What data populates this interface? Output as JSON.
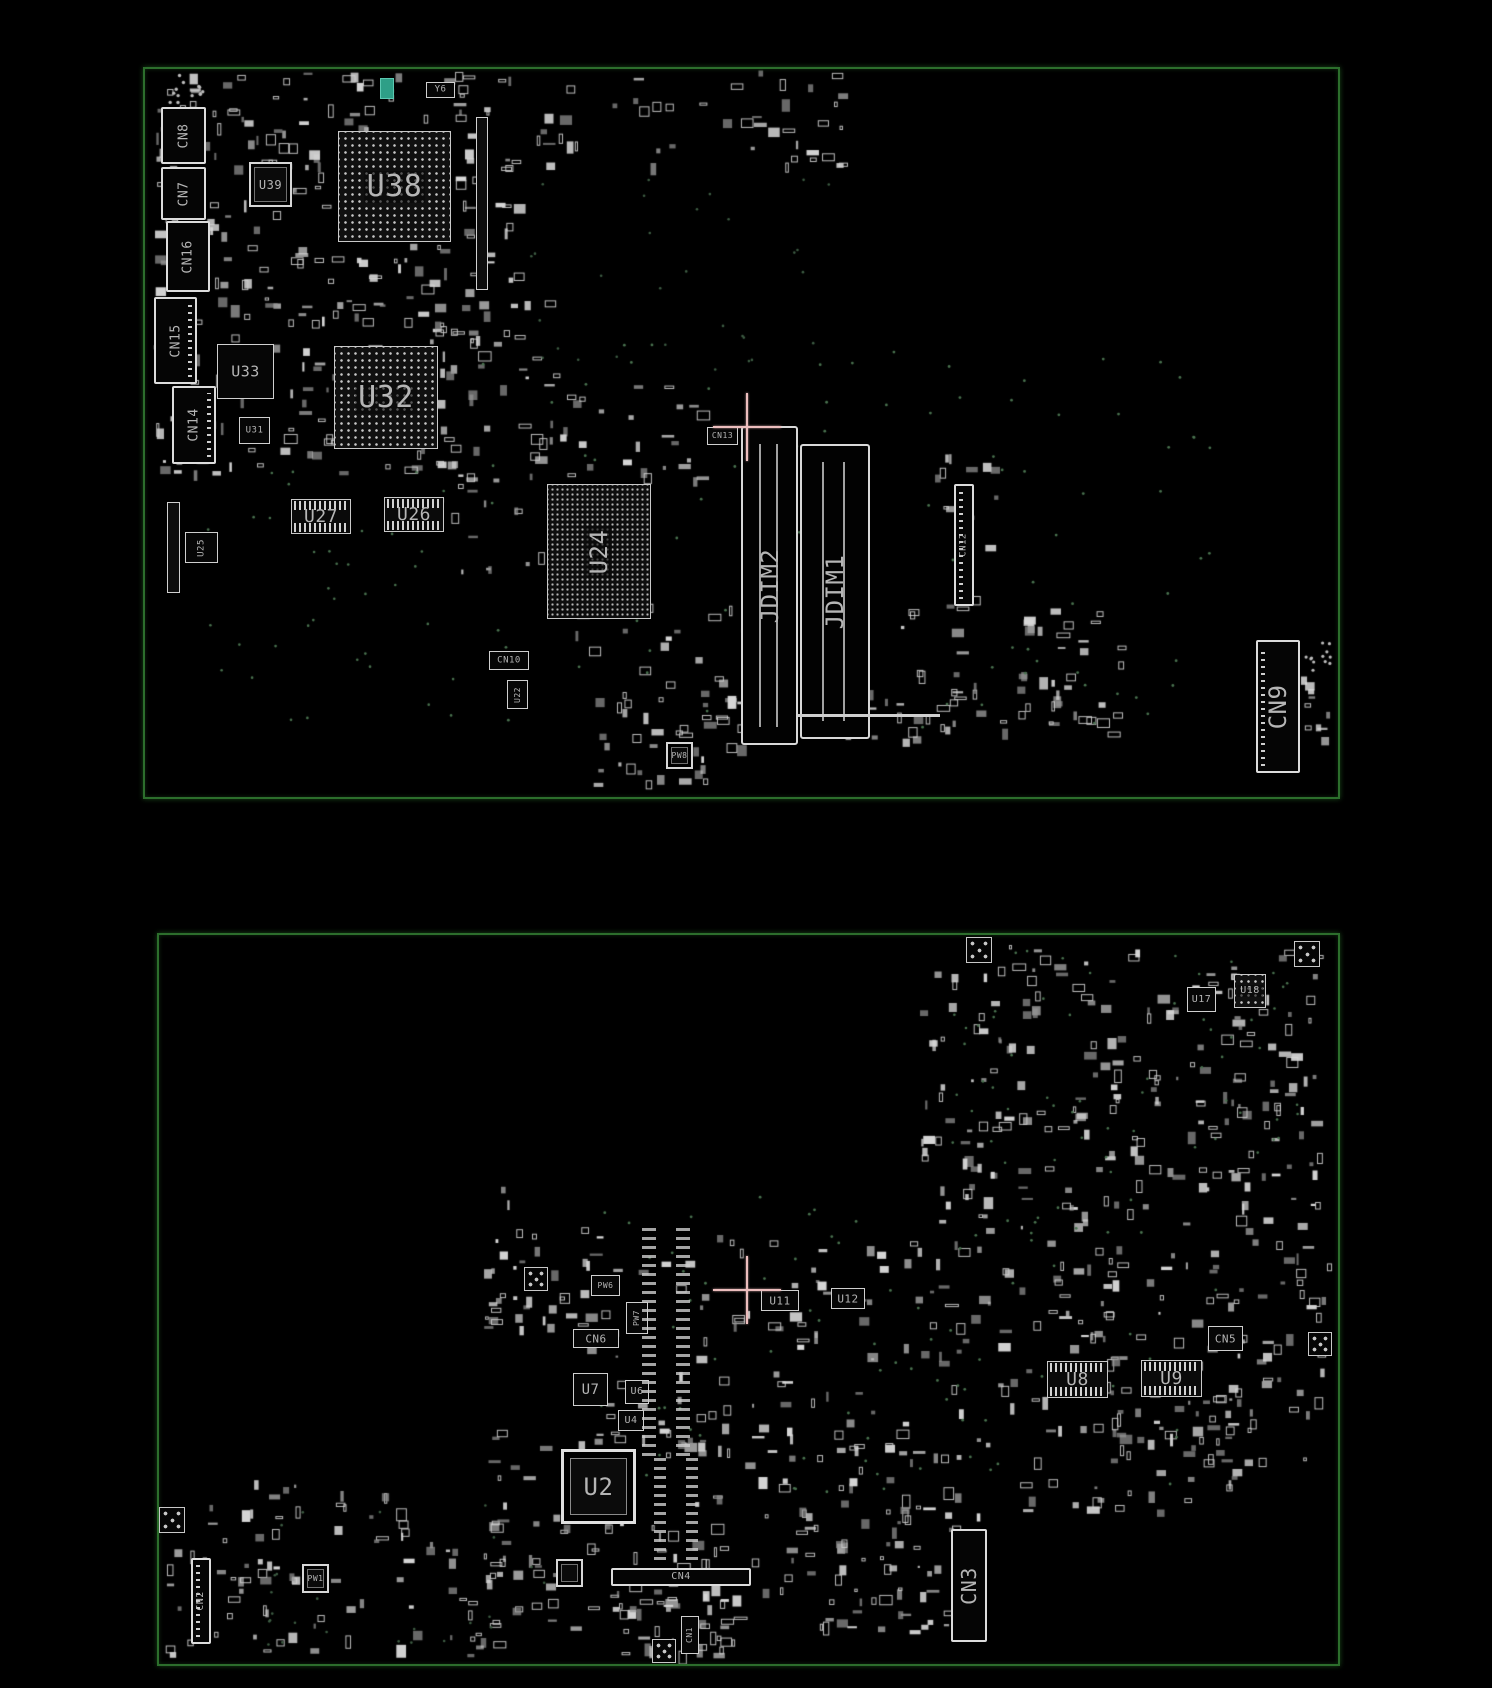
{
  "image": {
    "width": 1492,
    "height": 1688,
    "description": "PCB boardview drawing, two board sides on black background"
  },
  "colors": {
    "background": "#000000",
    "board_outline": "#2c6e2c",
    "component_stroke": "#d6d6d6",
    "component_dim": "#969696",
    "label_text": "#b5b5b5",
    "via_green": "#49724f",
    "crosshair": "#ecbdbd",
    "accent_teal": "#2e9f87"
  },
  "boards": [
    {
      "name": "board-top-side",
      "outline": {
        "x": 143,
        "y": 67,
        "w": 1193,
        "h": 728
      },
      "crosshair": {
        "x": 747,
        "y": 427,
        "arm": 34
      },
      "components": [
        {
          "label": "CN8",
          "type": "connector",
          "x": 161,
          "y": 107,
          "w": 45,
          "h": 57,
          "fs": 13,
          "rot": -90
        },
        {
          "label": "CN7",
          "type": "connector",
          "x": 161,
          "y": 167,
          "w": 45,
          "h": 53,
          "fs": 13,
          "rot": -90
        },
        {
          "label": "CN16",
          "type": "connector",
          "x": 166,
          "y": 221,
          "w": 44,
          "h": 71,
          "fs": 13,
          "rot": -90
        },
        {
          "label": "CN15",
          "type": "connector",
          "x": 154,
          "y": 297,
          "w": 43,
          "h": 87,
          "fs": 13,
          "rot": -90,
          "pins": "right"
        },
        {
          "label": "CN14",
          "type": "connector",
          "x": 172,
          "y": 386,
          "w": 44,
          "h": 78,
          "fs": 13,
          "rot": -90,
          "pins": "right"
        },
        {
          "label": "U39",
          "type": "qfp",
          "x": 249,
          "y": 162,
          "w": 43,
          "h": 45,
          "fs": 12
        },
        {
          "label": "U38",
          "type": "bga",
          "x": 338,
          "y": 131,
          "w": 113,
          "h": 111,
          "fs": 30
        },
        {
          "label": "U33",
          "type": "box",
          "x": 217,
          "y": 344,
          "w": 57,
          "h": 55,
          "fs": 15
        },
        {
          "label": "U31",
          "type": "box",
          "x": 239,
          "y": 417,
          "w": 31,
          "h": 27,
          "fs": 9
        },
        {
          "label": "U32",
          "type": "bga",
          "x": 334,
          "y": 346,
          "w": 104,
          "h": 103,
          "fs": 30
        },
        {
          "label": "U25",
          "type": "box",
          "x": 185,
          "y": 532,
          "w": 33,
          "h": 31,
          "fs": 9,
          "rot": -90
        },
        {
          "label": "U27",
          "type": "pinarray",
          "x": 291,
          "y": 499,
          "w": 60,
          "h": 35,
          "fs": 18
        },
        {
          "label": "U26",
          "type": "pinarray",
          "x": 384,
          "y": 497,
          "w": 60,
          "h": 35,
          "fs": 18
        },
        {
          "label": "U24",
          "type": "bga-fine",
          "x": 547,
          "y": 484,
          "w": 104,
          "h": 135,
          "fs": 24,
          "rot": -90
        },
        {
          "label": "JDIM2",
          "type": "slot",
          "x": 741,
          "y": 426,
          "w": 57,
          "h": 319,
          "fs": 24,
          "rot": -90
        },
        {
          "label": "JDIM1",
          "type": "slot",
          "x": 800,
          "y": 444,
          "w": 70,
          "h": 295,
          "fs": 24,
          "rot": -90
        },
        {
          "label": "CN13",
          "type": "box",
          "x": 707,
          "y": 427,
          "w": 31,
          "h": 18,
          "fs": 8
        },
        {
          "label": "CN12",
          "type": "connector",
          "x": 954,
          "y": 484,
          "w": 20,
          "h": 122,
          "fs": 9,
          "rot": -90,
          "pins": "left"
        },
        {
          "label": "CN9",
          "type": "connector",
          "x": 1256,
          "y": 640,
          "w": 44,
          "h": 133,
          "fs": 24,
          "rot": -90,
          "pins": "left"
        },
        {
          "label": "Y6",
          "type": "box",
          "x": 426,
          "y": 82,
          "w": 29,
          "h": 16,
          "fs": 9
        },
        {
          "label": "CN10",
          "type": "box",
          "x": 489,
          "y": 651,
          "w": 40,
          "h": 19,
          "fs": 9
        },
        {
          "label": "U22",
          "type": "box",
          "x": 507,
          "y": 680,
          "w": 21,
          "h": 29,
          "fs": 8,
          "rot": -90
        },
        {
          "label": "PW8",
          "type": "qfp",
          "x": 666,
          "y": 742,
          "w": 27,
          "h": 27,
          "fs": 8
        },
        {
          "label": "",
          "type": "bar",
          "x": 476,
          "y": 117,
          "w": 12,
          "h": 173
        },
        {
          "label": "",
          "type": "bar",
          "x": 167,
          "y": 502,
          "w": 13,
          "h": 91
        },
        {
          "label": "",
          "type": "hline",
          "x": 798,
          "y": 714,
          "w": 142,
          "h": 3
        },
        {
          "label": "",
          "type": "teal",
          "x": 380,
          "y": 78,
          "w": 14,
          "h": 21
        }
      ],
      "texture_clusters": [
        {
          "x": 150,
          "y": 72,
          "w": 320,
          "h": 235,
          "count": 150,
          "seed": 1
        },
        {
          "x": 150,
          "y": 300,
          "w": 330,
          "h": 175,
          "count": 120,
          "seed": 2
        },
        {
          "x": 455,
          "y": 70,
          "w": 60,
          "h": 230,
          "count": 30,
          "seed": 3
        },
        {
          "x": 520,
          "y": 70,
          "w": 340,
          "h": 95,
          "count": 45,
          "seed": 4
        },
        {
          "x": 425,
          "y": 300,
          "w": 130,
          "h": 270,
          "count": 45,
          "seed": 5
        },
        {
          "x": 555,
          "y": 385,
          "w": 150,
          "h": 95,
          "count": 26,
          "seed": 6
        },
        {
          "x": 575,
          "y": 600,
          "w": 175,
          "h": 185,
          "count": 55,
          "seed": 7
        },
        {
          "x": 700,
          "y": 690,
          "w": 240,
          "h": 55,
          "count": 28,
          "seed": 8
        },
        {
          "x": 880,
          "y": 600,
          "w": 230,
          "h": 135,
          "count": 45,
          "seed": 9
        },
        {
          "x": 935,
          "y": 440,
          "w": 70,
          "h": 170,
          "count": 14,
          "seed": 10
        },
        {
          "x": 1010,
          "y": 610,
          "w": 110,
          "h": 120,
          "count": 20,
          "seed": 11
        },
        {
          "x": 1295,
          "y": 675,
          "w": 35,
          "h": 95,
          "count": 10,
          "seed": 12
        }
      ],
      "dot_fields": [
        {
          "x": 168,
          "y": 74,
          "w": 38,
          "h": 40,
          "count": 14,
          "r": 1.7,
          "color": "#bdbdbd",
          "seed": 41
        },
        {
          "x": 1306,
          "y": 642,
          "w": 28,
          "h": 32,
          "count": 12,
          "r": 1.6,
          "color": "#bdbdbd",
          "seed": 42
        },
        {
          "x": 450,
          "y": 340,
          "w": 760,
          "h": 390,
          "count": 90,
          "r": 1.4,
          "color": "#49724f",
          "seed": 43
        },
        {
          "x": 200,
          "y": 470,
          "w": 260,
          "h": 250,
          "count": 40,
          "r": 1.3,
          "color": "#49724f",
          "seed": 44
        },
        {
          "x": 530,
          "y": 175,
          "w": 340,
          "h": 200,
          "count": 30,
          "r": 1.3,
          "color": "#3d5c43",
          "seed": 45
        }
      ]
    },
    {
      "name": "board-bottom-side",
      "outline": {
        "x": 157,
        "y": 933,
        "w": 1179,
        "h": 729
      },
      "crosshair": {
        "x": 747,
        "y": 1290,
        "arm": 34
      },
      "components": [
        {
          "label": "U17",
          "type": "box",
          "x": 1187,
          "y": 987,
          "w": 29,
          "h": 25,
          "fs": 10
        },
        {
          "label": "U18",
          "type": "bga",
          "x": 1234,
          "y": 974,
          "w": 32,
          "h": 34,
          "fs": 10
        },
        {
          "label": "U11",
          "type": "box",
          "x": 761,
          "y": 1290,
          "w": 38,
          "h": 21,
          "fs": 11
        },
        {
          "label": "U12",
          "type": "box",
          "x": 831,
          "y": 1288,
          "w": 34,
          "h": 21,
          "fs": 11
        },
        {
          "label": "CN6",
          "type": "box",
          "x": 573,
          "y": 1329,
          "w": 46,
          "h": 19,
          "fs": 11
        },
        {
          "label": "U7",
          "type": "box",
          "x": 573,
          "y": 1373,
          "w": 35,
          "h": 33,
          "fs": 14
        },
        {
          "label": "U6",
          "type": "box",
          "x": 625,
          "y": 1380,
          "w": 24,
          "h": 24,
          "fs": 10
        },
        {
          "label": "U4",
          "type": "box",
          "x": 618,
          "y": 1410,
          "w": 26,
          "h": 21,
          "fs": 10
        },
        {
          "label": "U2",
          "type": "qfp-big",
          "x": 561,
          "y": 1449,
          "w": 75,
          "h": 75,
          "fs": 24
        },
        {
          "label": "CN4",
          "type": "connector-h",
          "x": 611,
          "y": 1568,
          "w": 140,
          "h": 18,
          "fs": 10
        },
        {
          "label": "CN1",
          "type": "box",
          "x": 681,
          "y": 1616,
          "w": 18,
          "h": 38,
          "fs": 8,
          "rot": -90
        },
        {
          "label": "CN2",
          "type": "connector",
          "x": 191,
          "y": 1558,
          "w": 20,
          "h": 86,
          "fs": 10,
          "rot": -90,
          "pins": "left"
        },
        {
          "label": "CN3",
          "type": "connector",
          "x": 951,
          "y": 1529,
          "w": 36,
          "h": 113,
          "fs": 20,
          "rot": -90
        },
        {
          "label": "U8",
          "type": "pinarray",
          "x": 1047,
          "y": 1361,
          "w": 61,
          "h": 37,
          "fs": 18
        },
        {
          "label": "U9",
          "type": "pinarray",
          "x": 1141,
          "y": 1360,
          "w": 61,
          "h": 37,
          "fs": 18
        },
        {
          "label": "CN5",
          "type": "box",
          "x": 1208,
          "y": 1326,
          "w": 35,
          "h": 25,
          "fs": 11
        },
        {
          "label": "PW6",
          "type": "box",
          "x": 591,
          "y": 1275,
          "w": 29,
          "h": 21,
          "fs": 8
        },
        {
          "label": "PW7",
          "type": "box",
          "x": 626,
          "y": 1302,
          "w": 22,
          "h": 32,
          "fs": 8,
          "rot": -90
        },
        {
          "label": "PW1",
          "type": "qfp",
          "x": 302,
          "y": 1564,
          "w": 27,
          "h": 29,
          "fs": 8
        },
        {
          "label": "",
          "type": "qfp",
          "x": 556,
          "y": 1559,
          "w": 27,
          "h": 28
        },
        {
          "label": "",
          "type": "fiducial",
          "x": 966,
          "y": 937,
          "w": 26,
          "h": 26
        },
        {
          "label": "",
          "type": "fiducial",
          "x": 1294,
          "y": 941,
          "w": 26,
          "h": 26
        },
        {
          "label": "",
          "type": "fiducial",
          "x": 159,
          "y": 1507,
          "w": 26,
          "h": 26
        },
        {
          "label": "",
          "type": "fiducial",
          "x": 652,
          "y": 1639,
          "w": 24,
          "h": 24
        },
        {
          "label": "",
          "type": "fiducial",
          "x": 1308,
          "y": 1332,
          "w": 24,
          "h": 24
        },
        {
          "label": "",
          "type": "fiducial",
          "x": 524,
          "y": 1267,
          "w": 24,
          "h": 24
        },
        {
          "label": "",
          "type": "vdash",
          "x": 642,
          "y": 1228,
          "w": 14,
          "h": 228
        },
        {
          "label": "",
          "type": "vdash",
          "x": 676,
          "y": 1228,
          "w": 14,
          "h": 228
        },
        {
          "label": "",
          "type": "vdash",
          "x": 654,
          "y": 1452,
          "w": 12,
          "h": 108
        },
        {
          "label": "",
          "type": "vdash",
          "x": 686,
          "y": 1452,
          "w": 12,
          "h": 108
        }
      ],
      "texture_clusters": [
        {
          "x": 920,
          "y": 945,
          "w": 400,
          "h": 285,
          "count": 230,
          "seed": 21
        },
        {
          "x": 1090,
          "y": 1235,
          "w": 240,
          "h": 225,
          "count": 110,
          "seed": 22
        },
        {
          "x": 900,
          "y": 1240,
          "w": 190,
          "h": 115,
          "count": 40,
          "seed": 23
        },
        {
          "x": 575,
          "y": 1235,
          "w": 320,
          "h": 215,
          "count": 85,
          "seed": 24
        },
        {
          "x": 480,
          "y": 1185,
          "w": 115,
          "h": 145,
          "count": 35,
          "seed": 25
        },
        {
          "x": 480,
          "y": 1420,
          "w": 255,
          "h": 235,
          "count": 110,
          "seed": 26
        },
        {
          "x": 165,
          "y": 1480,
          "w": 320,
          "h": 175,
          "count": 85,
          "seed": 27
        },
        {
          "x": 745,
          "y": 1420,
          "w": 215,
          "h": 175,
          "count": 55,
          "seed": 28
        },
        {
          "x": 935,
          "y": 1360,
          "w": 300,
          "h": 155,
          "count": 60,
          "seed": 29
        },
        {
          "x": 560,
          "y": 1590,
          "w": 185,
          "h": 65,
          "count": 25,
          "seed": 30
        },
        {
          "x": 790,
          "y": 1505,
          "w": 165,
          "h": 130,
          "count": 40,
          "seed": 31
        }
      ],
      "dot_fields": [
        {
          "x": 600,
          "y": 1195,
          "w": 620,
          "h": 300,
          "count": 80,
          "r": 1.4,
          "color": "#49724f",
          "seed": 51
        },
        {
          "x": 950,
          "y": 950,
          "w": 360,
          "h": 250,
          "count": 60,
          "r": 1.3,
          "color": "#49724f",
          "seed": 52
        },
        {
          "x": 250,
          "y": 1490,
          "w": 300,
          "h": 160,
          "count": 25,
          "r": 1.3,
          "color": "#3d5c43",
          "seed": 53
        }
      ]
    }
  ]
}
